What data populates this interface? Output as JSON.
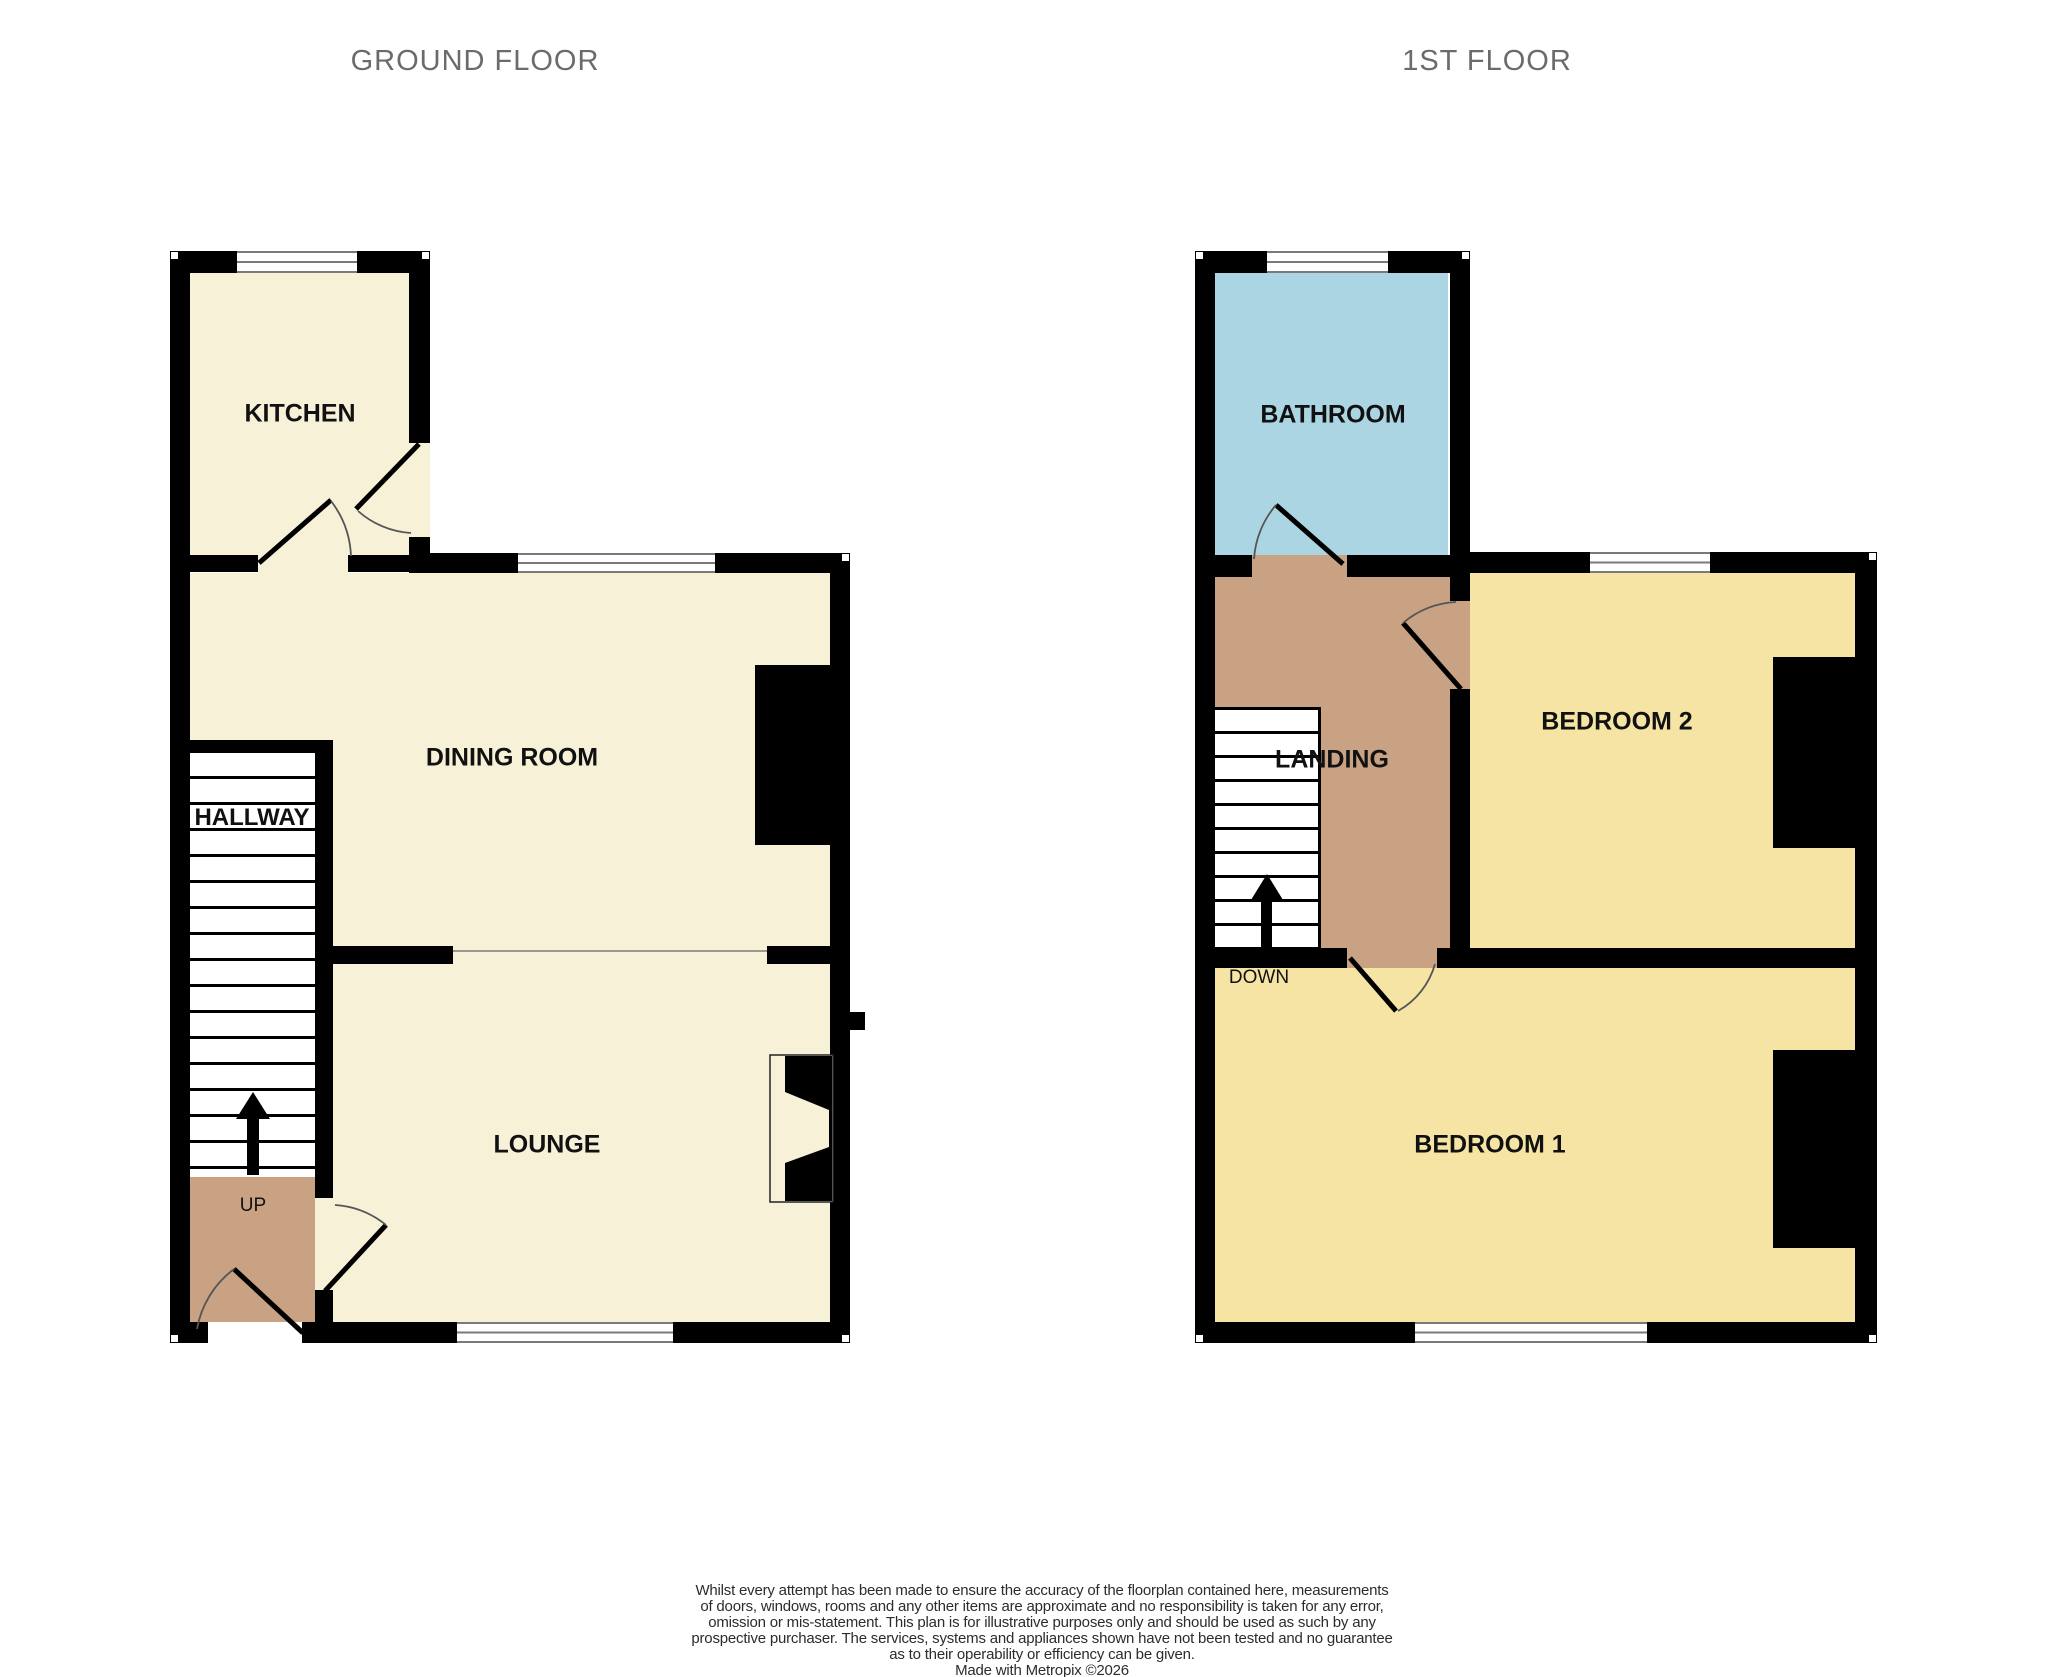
{
  "floors": [
    {
      "title": "GROUND FLOOR",
      "rooms": [
        {
          "label": "KITCHEN"
        },
        {
          "label": "DINING ROOM"
        },
        {
          "label": "HALLWAY"
        },
        {
          "label": "LOUNGE"
        }
      ],
      "stair_label": "UP"
    },
    {
      "title": "1ST FLOOR",
      "rooms": [
        {
          "label": "BATHROOM"
        },
        {
          "label": "LANDING"
        },
        {
          "label": "BEDROOM 2"
        },
        {
          "label": "BEDROOM 1"
        }
      ],
      "stair_label": "DOWN"
    }
  ],
  "disclaimer": {
    "lines": [
      "Whilst every attempt has been made to ensure the accuracy of the floorplan contained here, measurements",
      "of doors, windows, rooms and any other items are approximate and no responsibility is taken for any error,",
      "omission or mis-statement. This plan is for illustrative purposes only and should be used as such by any",
      "prospective purchaser. The services, systems and appliances shown have not been tested and no guarantee",
      "as to their operability or efficiency can be given.",
      "Made with Metropix ©2026"
    ]
  },
  "colors": {
    "wall": "#000000",
    "cream": "#f7f1d8",
    "bedroom-yellow": "#f5e4a4",
    "bathroom-blue": "#abd5e2",
    "hall-tan": "#c9a284",
    "window-line": "#7a7a7a",
    "divider-line": "#9a9a8f",
    "title-gray": "#6b6b6b",
    "label-black": "#111111",
    "arc": "#555555"
  }
}
